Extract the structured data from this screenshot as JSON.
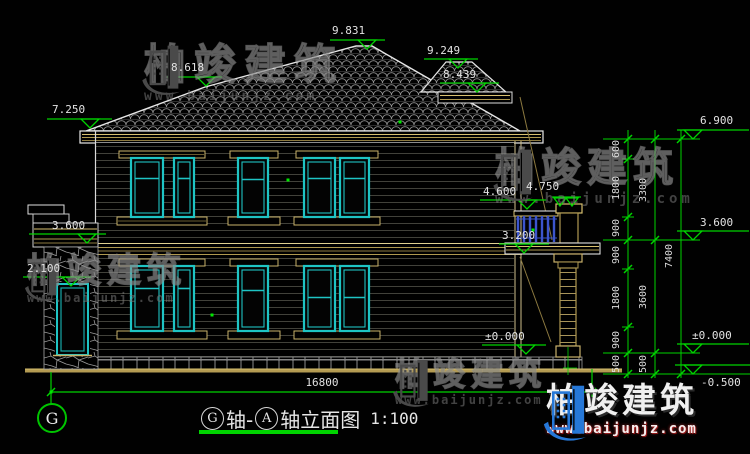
{
  "colors": {
    "background": "#010101",
    "annotation_green": "#00d400",
    "window_cyan": "#1ec4c4",
    "trim_tan": "#c9b26a",
    "wall_line_gray": "#41413a",
    "roof_line_gray": "#8f8f8f",
    "outline_white": "#e6e6e6",
    "baluster_blue": "#3c55cc",
    "watermark_gray": "#4a4a4a",
    "logo_blue": "#2678d8"
  },
  "elevations": {
    "main_ridge": "9.831",
    "left_ridge": "8.618",
    "left_eave": "7.250",
    "secondary_ridge": "9.249",
    "secondary_eave": "8.439",
    "wing_roof": "3.600",
    "door_head": "2.100",
    "balcony_rail": "4.600",
    "pillar_top": "4.750",
    "balcony_floor": "3.200",
    "ground_floor": "±0.000",
    "right_eave": "6.900",
    "right_second_floor": "3.600",
    "right_ground": "±0.000",
    "right_site": "-0.500"
  },
  "dimensions": {
    "total_width": "16800",
    "inner": [
      "600",
      "1800",
      "900",
      "900",
      "1800",
      "900",
      "500"
    ],
    "mid": [
      "3300",
      "3600",
      "500"
    ],
    "outer": [
      "7400"
    ]
  },
  "axis": {
    "bubble": "G"
  },
  "title": {
    "axis_start": "G",
    "mid": "轴-",
    "axis_end": "A",
    "suffix": "轴立面图",
    "scale": "1:100"
  },
  "watermark": {
    "brand": "柏竣建筑",
    "url": "www.baijunjz.com"
  },
  "logo": {
    "brand": "柏竣建筑",
    "url": "www.baijunjz.com"
  }
}
